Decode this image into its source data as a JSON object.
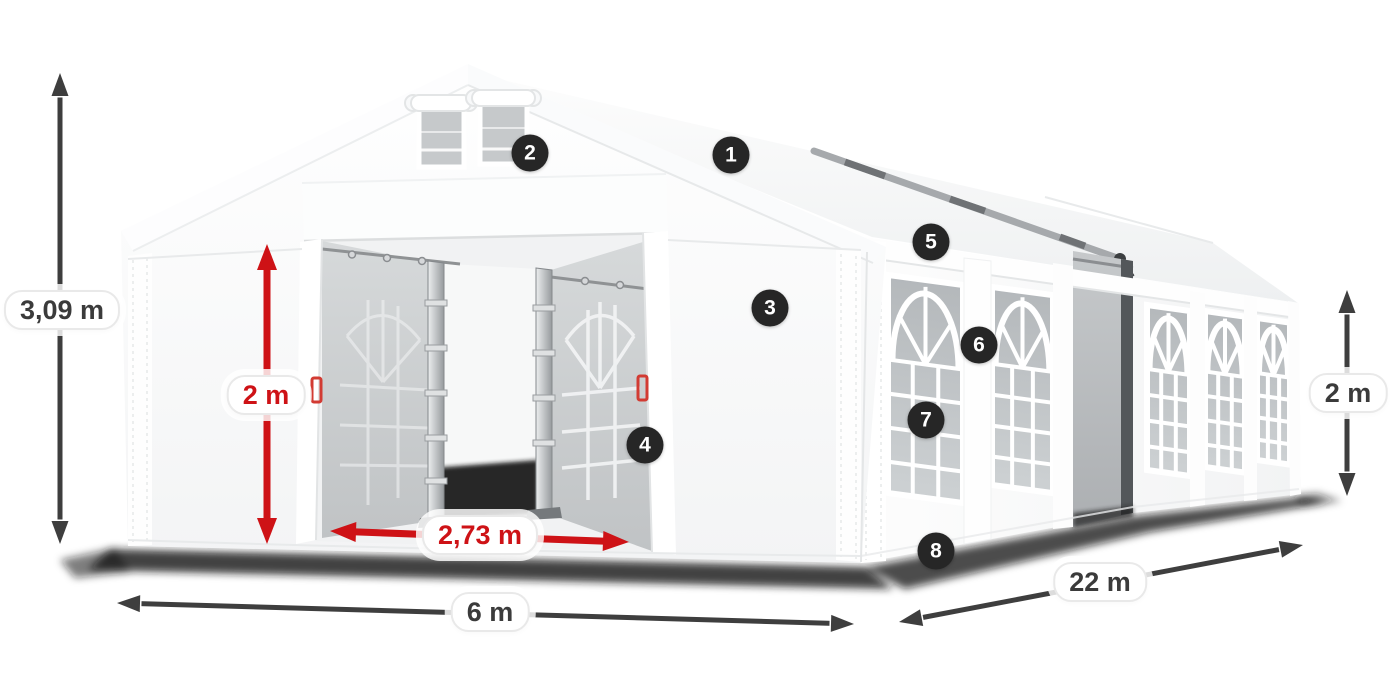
{
  "illustration": {
    "name": "party-tent-6x22m-diagram",
    "accent_red": "#ce1216",
    "dim_dark": "#3e3e3e",
    "badge_bg": "#262626",
    "badge_text_color": "#ffffff"
  },
  "dimensions": [
    {
      "id": "total-height",
      "value": "3,09 m",
      "color": "dark"
    },
    {
      "id": "door-height",
      "value": "2 m",
      "color": "red"
    },
    {
      "id": "door-width",
      "value": "2,73 m",
      "color": "red"
    },
    {
      "id": "front-width",
      "value": "6 m",
      "color": "dark"
    },
    {
      "id": "side-length",
      "value": "22 m",
      "color": "dark"
    },
    {
      "id": "side-height",
      "value": "2 m",
      "color": "dark"
    }
  ],
  "badges": [
    {
      "number": "1"
    },
    {
      "number": "2"
    },
    {
      "number": "3"
    },
    {
      "number": "4"
    },
    {
      "number": "5"
    },
    {
      "number": "6"
    },
    {
      "number": "7"
    },
    {
      "number": "8"
    }
  ]
}
